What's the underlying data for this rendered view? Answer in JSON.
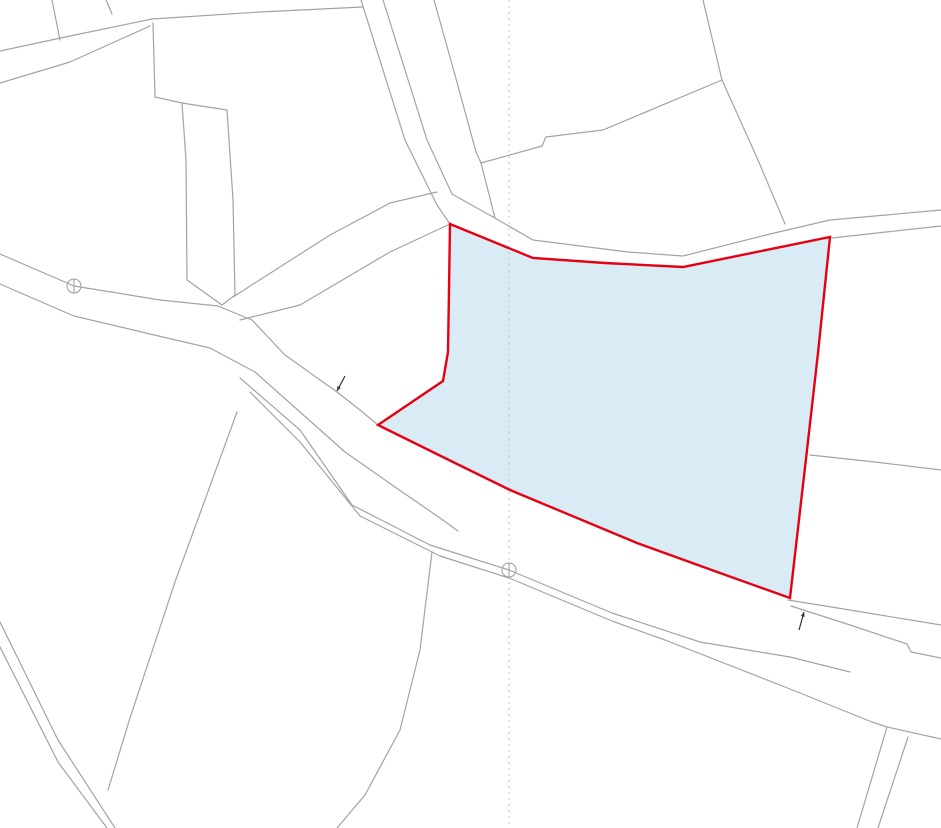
{
  "map": {
    "colors": {
      "background": "#ffffff",
      "boundary_line": "#a3a3a3",
      "grid_line": "#c4c4c4",
      "highlight_stroke": "#e60012",
      "highlight_fill": "#d9ebf4",
      "label_text": "#222222",
      "arrow": "#333333"
    },
    "highlighted_parcel": {
      "number": "181-2",
      "points": "450,224 533,258 605,263 683,267 830,237 818,353 807,450 790,598 720,573 637,543 510,490 455,463 378,425 443,381 448,352 449,290"
    },
    "parcel_labels": [
      {
        "text": "179-2",
        "x": 88,
        "y": 147,
        "size": 21,
        "rot": 0
      },
      {
        "text": "180",
        "x": 203,
        "y": 145,
        "size": 21,
        "rot": 0
      },
      {
        "text": "-6",
        "x": 198,
        "y": 165,
        "size": 21,
        "rot": 0
      },
      {
        "text": "180-2",
        "x": 310,
        "y": 168,
        "size": 21,
        "rot": 0
      },
      {
        "text": "178-2",
        "x": 430,
        "y": 69,
        "size": 21,
        "rot": 0
      },
      {
        "text": "178-3",
        "x": 581,
        "y": 42,
        "size": 21,
        "rot": 0
      },
      {
        "text": "176",
        "x": 634,
        "y": 184,
        "size": 21,
        "rot": 0
      },
      {
        "text": "180-5",
        "x": 330,
        "y": 262,
        "size": 20,
        "rot": -27
      },
      {
        "text": "180-4",
        "x": 381,
        "y": 329,
        "size": 21,
        "rot": 0
      },
      {
        "text": "181-2",
        "x": 637,
        "y": 400,
        "size": 21,
        "rot": 0
      },
      {
        "text": "182-4",
        "x": 884,
        "y": 357,
        "size": 21,
        "rot": 0
      },
      {
        "text": "182-1",
        "x": 876,
        "y": 552,
        "size": 21,
        "rot": 0
      },
      {
        "text": "13",
        "x": 66,
        "y": 492,
        "size": 21,
        "rot": 0
      },
      {
        "text": "14",
        "x": 270,
        "y": 692,
        "size": 21,
        "rot": 0
      },
      {
        "text": "15-1",
        "x": 612,
        "y": 762,
        "size": 21,
        "rot": 0
      }
    ],
    "annotation_labels": [
      {
        "text": "道",
        "x": 285,
        "y": 411,
        "size": 24,
        "rot": 0,
        "kind": "road"
      },
      {
        "text": "水",
        "x": 347,
        "y": 376,
        "size": 24,
        "rot": 0,
        "kind": "water"
      },
      {
        "text": "道",
        "x": 730,
        "y": 626,
        "size": 24,
        "rot": 0,
        "kind": "road"
      },
      {
        "text": "水",
        "x": 797,
        "y": 649,
        "size": 24,
        "rot": 0,
        "kind": "water"
      },
      {
        "text": "道",
        "x": 377,
        "y": 58,
        "size": 20,
        "rot": 105,
        "kind": "road"
      },
      {
        "text": "道",
        "x": 878,
        "y": 767,
        "size": 20,
        "rot": 70,
        "kind": "road"
      },
      {
        "text": "道",
        "x": 628,
        "y": 252,
        "size": 11,
        "rot": -4,
        "kind": "road"
      },
      {
        "text": "水",
        "x": 352,
        "y": 504,
        "size": 11,
        "rot": 24,
        "kind": "water"
      },
      {
        "text": "水",
        "x": 612,
        "y": 618,
        "size": 11,
        "rot": 20,
        "kind": "water"
      },
      {
        "text": "水",
        "x": 56,
        "y": 744,
        "size": 11,
        "rot": 45,
        "kind": "water"
      }
    ],
    "boundary_lines": [
      {
        "name": "road-topleft-north",
        "points": "0,51 70,36 152,19"
      },
      {
        "name": "road-topleft-south",
        "points": "0,83 70,62 150,26"
      },
      {
        "name": "topleft-long-boundary",
        "points": "152,19 260,12 363,7"
      },
      {
        "name": "topleft-sliver-1",
        "points": "52,0 60,40"
      },
      {
        "name": "topleft-sliver-2",
        "points": "106,0 112,14"
      },
      {
        "name": "parcel-179-2-east",
        "points": "153,23 155,97 182,103 186,160 187,280 222,305"
      },
      {
        "name": "parcel-180-6-top",
        "points": "182,103 227,110"
      },
      {
        "name": "parcel-180-6-east",
        "points": "227,110 233,200 235,295 222,305"
      },
      {
        "name": "road-top-west-line",
        "points": "361,0 405,140 437,205 450,224"
      },
      {
        "name": "road-top-east-line",
        "points": "383,0 427,140 452,194"
      },
      {
        "name": "road-upper-north-edge",
        "points": "452,194 493,217 533,240 628,252 683,256 770,234 830,220 941,210"
      },
      {
        "name": "road-upper-south-east",
        "points": "832,238 886,232 941,226"
      },
      {
        "name": "parcel-178-2-east",
        "points": "434,0 455,75 470,130 476,152 481,163 495,218"
      },
      {
        "name": "parcel-178-3-east",
        "points": "703,0 722,80"
      },
      {
        "name": "parcel-178-3-south",
        "points": "722,80 603,130 546,137 542,146 481,163"
      },
      {
        "name": "parcel-176-east",
        "points": "722,80 758,160 785,224"
      },
      {
        "name": "parcel-180-2-180-5",
        "points": "437,192 390,203 330,235 233,297"
      },
      {
        "name": "parcel-180-5-180-4",
        "points": "450,224 390,252 300,305 240,320"
      },
      {
        "name": "main-road-north-edge",
        "points": "0,254 74,286 160,300 218,306 252,320 285,355 337,392 360,410 378,425"
      },
      {
        "name": "main-road-south-edge",
        "points": "0,284 74,316 150,334 210,348 255,372 300,412 345,452 395,487 440,518 458,531"
      },
      {
        "name": "water-channel-mid-north",
        "points": "240,378 300,430 352,505 430,545 509,570 612,613 700,642 790,657 850,672"
      },
      {
        "name": "water-channel-mid-south",
        "points": "250,392 300,442 360,516 440,556 509,578 612,621 665,640 790,689 872,722 887,727 941,739"
      },
      {
        "name": "water-strip-east-north",
        "points": "788,600 850,610 941,625"
      },
      {
        "name": "water-strip-east-south",
        "points": "791,606 850,625 907,644 911,652 941,658"
      },
      {
        "name": "parcel-182-4-182-1",
        "points": "810,455 875,462 941,470"
      },
      {
        "name": "parcel-13-14",
        "points": "237,412 175,582 130,718 108,790"
      },
      {
        "name": "parcel-14-east",
        "points": "432,552 420,650 400,730 365,795 337,828"
      },
      {
        "name": "channel-southwest-north",
        "points": "0,622 58,740 115,828"
      },
      {
        "name": "channel-southwest-south",
        "points": "0,647 58,762 107,828"
      },
      {
        "name": "road-southeast-west",
        "points": "887,727 857,828"
      },
      {
        "name": "road-southeast-east",
        "points": "908,737 878,828"
      }
    ],
    "grid_line": {
      "name": "vertical-grid-line",
      "points": "509,0 509,828",
      "dash": "2,4"
    },
    "survey_circles": [
      {
        "x": 74,
        "y": 286,
        "r": 7
      },
      {
        "x": 509,
        "y": 570,
        "r": 7
      }
    ],
    "arrows": [
      {
        "x1": 345,
        "y1": 376,
        "x2": 337,
        "y2": 391
      },
      {
        "x1": 799,
        "y1": 630,
        "x2": 804,
        "y2": 612
      }
    ]
  }
}
